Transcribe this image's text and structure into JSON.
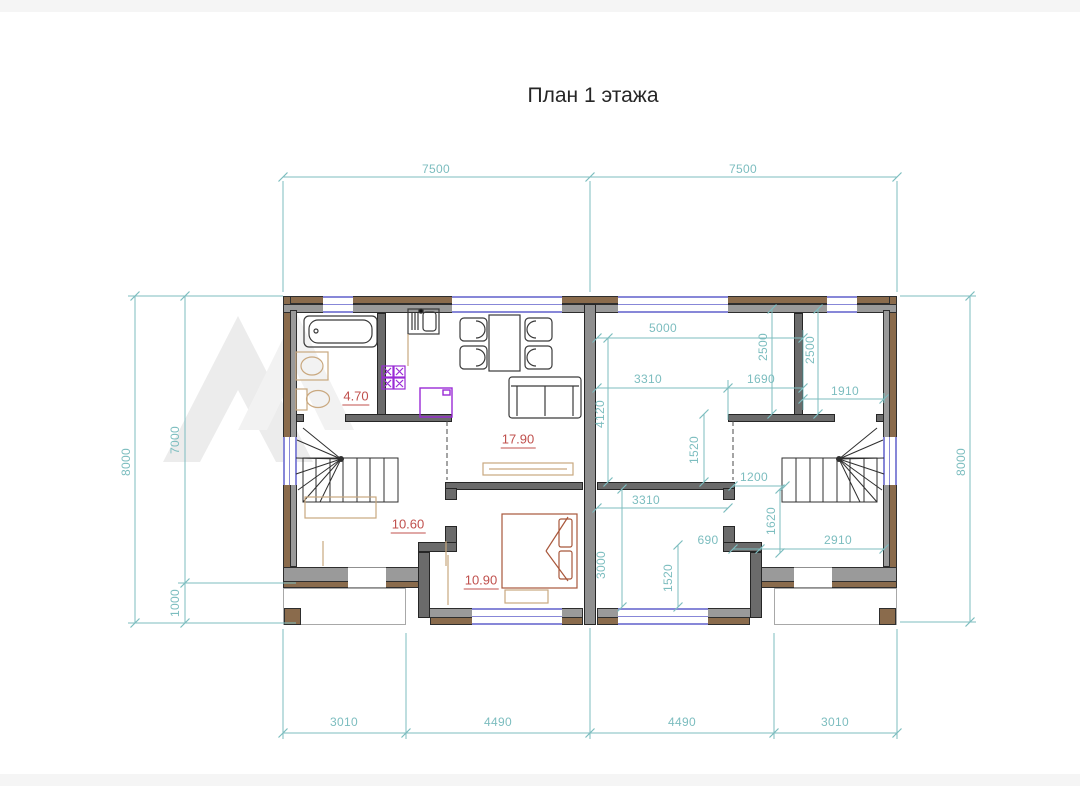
{
  "title": "План 1 этажа",
  "dims": {
    "top": [
      "7500",
      "7500"
    ],
    "bottom": [
      "3010",
      "4490",
      "4490",
      "3010"
    ],
    "left": {
      "overall": "8000",
      "upper": "7000",
      "lower": "1000"
    },
    "right": {
      "overall": "8000"
    },
    "interior": {
      "w5000": "5000",
      "h2500a": "2500",
      "h2500b": "2500",
      "w3310a": "3310",
      "w1690": "1690",
      "w1910": "1910",
      "h4120": "4120",
      "h1520a": "1520",
      "w1200": "1200",
      "w3310b": "3310",
      "h1620": "1620",
      "w690": "690",
      "w2910": "2910",
      "h3000": "3000",
      "h1520b": "1520"
    }
  },
  "rooms": {
    "bathroom_area": "4.70",
    "living_area": "17.90",
    "hall_area": "10.60",
    "bedroom_area": "10.90"
  },
  "colors": {
    "dimension_teal": "#7cbdbf",
    "area_red": "#c0504d",
    "wall_brown": "#8a6b4c",
    "wall_gray": "#9a9a9a",
    "window_blue": "#8787d8",
    "kitchen_purple": "#9a2bd6",
    "fixture_tan": "#c9a87f",
    "bed_brown": "#a8573b"
  }
}
